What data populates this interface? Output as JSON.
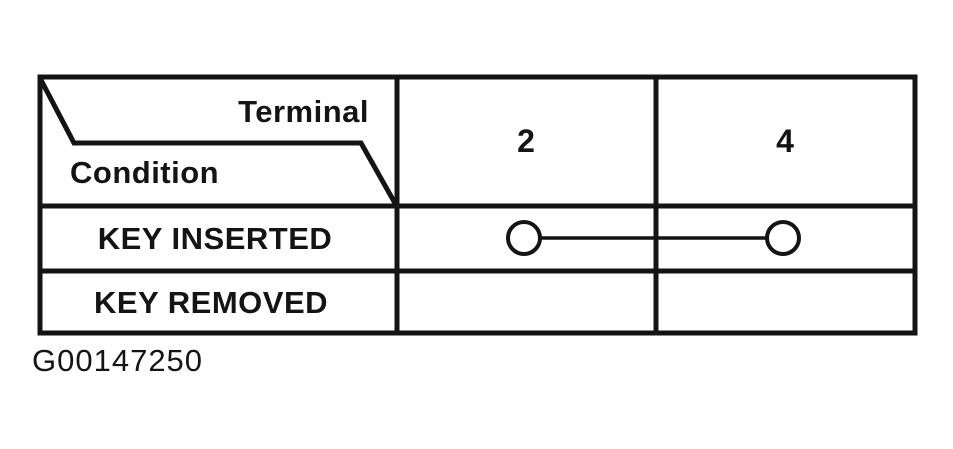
{
  "figure": {
    "type": "terminal-continuity-table",
    "caption": "G00147250",
    "colors": {
      "ink": "#141414",
      "paper": "#ffffff"
    },
    "table": {
      "header": {
        "terminal_label": "Terminal",
        "condition_label": "Condition",
        "columns": [
          "2",
          "4"
        ]
      },
      "rows": [
        {
          "condition": "KEY INSERTED",
          "continuity_between_terminals": [
            "2",
            "4"
          ]
        },
        {
          "condition": "KEY REMOVED",
          "continuity_between_terminals": []
        }
      ]
    }
  }
}
